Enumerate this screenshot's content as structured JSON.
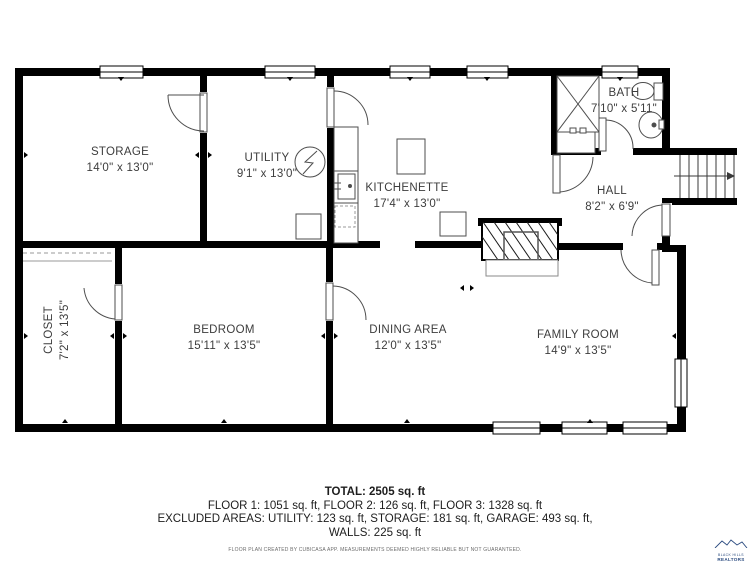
{
  "plan": {
    "rooms": [
      {
        "id": "storage",
        "name": "STORAGE",
        "dims": "14'0\" x 13'0\""
      },
      {
        "id": "utility",
        "name": "UTILITY",
        "dims": "9'1\" x 13'0\""
      },
      {
        "id": "kitchenette",
        "name": "KITCHENETTE",
        "dims": "17'4\" x 13'0\""
      },
      {
        "id": "bath",
        "name": "BATH",
        "dims": "7'10\" x 5'11\""
      },
      {
        "id": "hall",
        "name": "HALL",
        "dims": "8'2\" x 6'9\""
      },
      {
        "id": "closet",
        "name": "CLOSET",
        "dims": "7'2\" x 13'5\""
      },
      {
        "id": "bedroom",
        "name": "BEDROOM",
        "dims": "15'11\" x 13'5\""
      },
      {
        "id": "dining",
        "name": "DINING AREA",
        "dims": "12'0\" x 13'5\""
      },
      {
        "id": "family",
        "name": "FAMILY ROOM",
        "dims": "14'9\" x 13'5\""
      }
    ]
  },
  "summary": {
    "total": "TOTAL: 2505 sq. ft",
    "floors": "FLOOR 1: 1051 sq. ft, FLOOR 2: 126 sq. ft, FLOOR 3: 1328 sq. ft",
    "excluded": "EXCLUDED AREAS: UTILITY: 123 sq. ft, STORAGE: 181 sq. ft, GARAGE: 493 sq. ft,",
    "walls": "WALLS: 225 sq. ft",
    "disclaimer": "FLOOR PLAN CREATED BY CUBICASA APP. MEASUREMENTS DEEMED HIGHLY RELIABLE BUT NOT GUARANTEED."
  },
  "logo": {
    "line1": "BLACK HILLS",
    "line2": "REALTORS"
  },
  "colors": {
    "wall": "#000000",
    "fixture": "#4d4d4d",
    "label": "#3d3d3d",
    "logo_blue": "#2a4a7f"
  }
}
